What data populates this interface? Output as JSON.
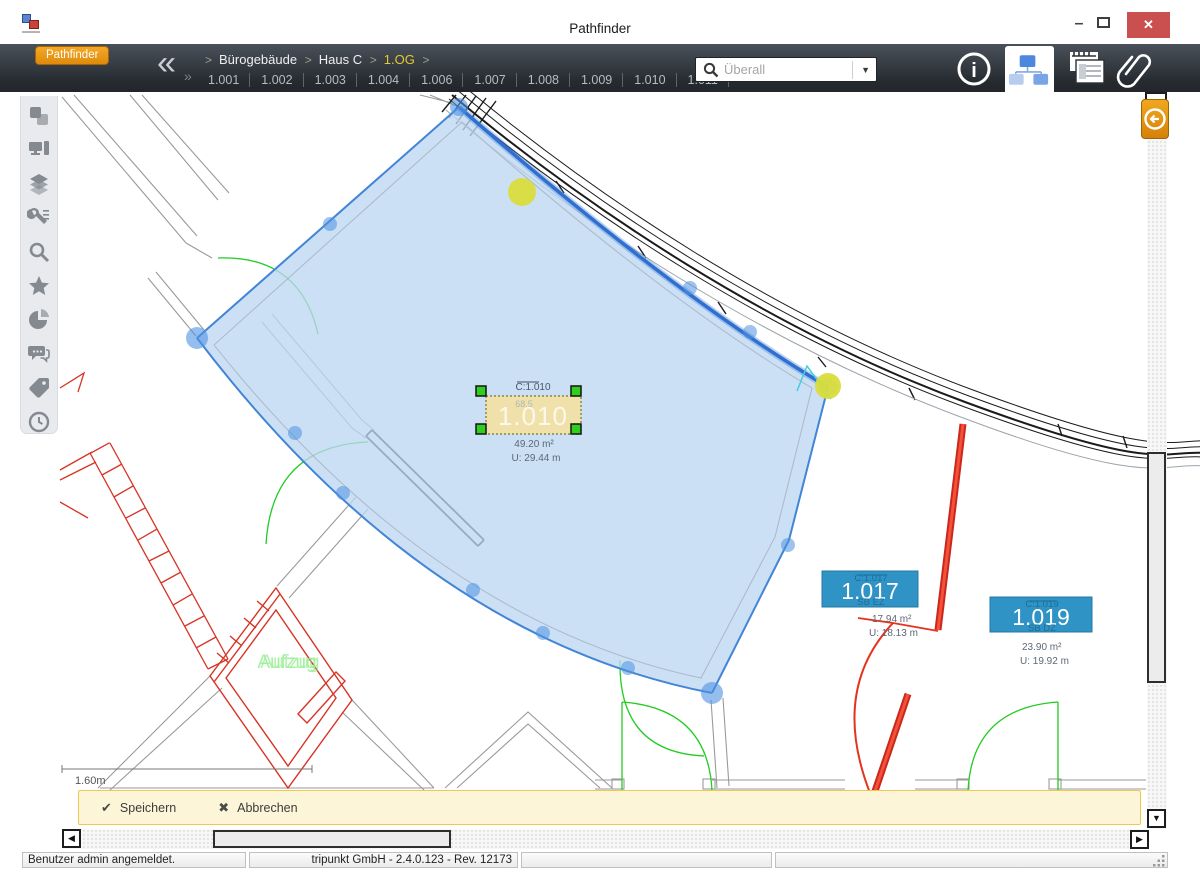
{
  "window": {
    "title": "Pathfinder",
    "controls": {
      "minimize_glyph": "–",
      "close_glyph": "✕"
    }
  },
  "toolbar": {
    "badge": "Pathfinder",
    "collapse_glyph": "«",
    "expand_glyph": "»",
    "breadcrumb": [
      "Bürogebäude",
      "Haus C",
      "1.OG"
    ],
    "rooms": [
      "1.001",
      "1.002",
      "1.003",
      "1.004",
      "1.006",
      "1.007",
      "1.008",
      "1.009",
      "1.010",
      "1.011",
      "···"
    ],
    "search_placeholder": "Überall",
    "info_glyph": "i"
  },
  "sidebar": {
    "tools": [
      "structure",
      "workstation",
      "layers",
      "settings",
      "search",
      "favorites",
      "statistics",
      "comments",
      "tags",
      "history"
    ]
  },
  "plan": {
    "room_1010": {
      "code": "C:1.010",
      "label": "1.010",
      "bg_note": "68.5",
      "area": "49.20 m²",
      "perimeter": "U: 29.44 m"
    },
    "room_1017": {
      "code": "C:1.017",
      "label": "1.017",
      "subtype": "SB EZ",
      "area": "17.94 m²",
      "perimeter": "U: 18.13 m"
    },
    "room_1019": {
      "code": "C:1.019",
      "label": "1.019",
      "subtype": "SB DZ",
      "area": "23.90 m²",
      "perimeter": "U: 19.92 m"
    },
    "elevator_label": "Aufzug",
    "scale_label": "1.60m"
  },
  "actions": {
    "save_icon": "✔",
    "save": "Speichern",
    "cancel_icon": "✖",
    "cancel": "Abbrechen"
  },
  "statusbar": {
    "user": "Benutzer admin angemeldet.",
    "version": "tripunkt GmbH - 2.4.0.123 - Rev. 12173"
  },
  "scroll": {
    "left": "◀",
    "right": "▶",
    "down": "▼",
    "dropdown": "▼"
  },
  "colors": {
    "badge_orange": "#e8940f",
    "selection_blue": "#3b7cd4",
    "selection_fill": "#c9ddf4",
    "room_box_blue": "#2f93c5",
    "label_yellow": "#f3e1a4",
    "handle_green": "#2fd01d",
    "vertex_yellow": "#d9dd3c",
    "cad_red": "#d63425",
    "cad_green": "#22cc22",
    "close_red": "#c9504e"
  }
}
